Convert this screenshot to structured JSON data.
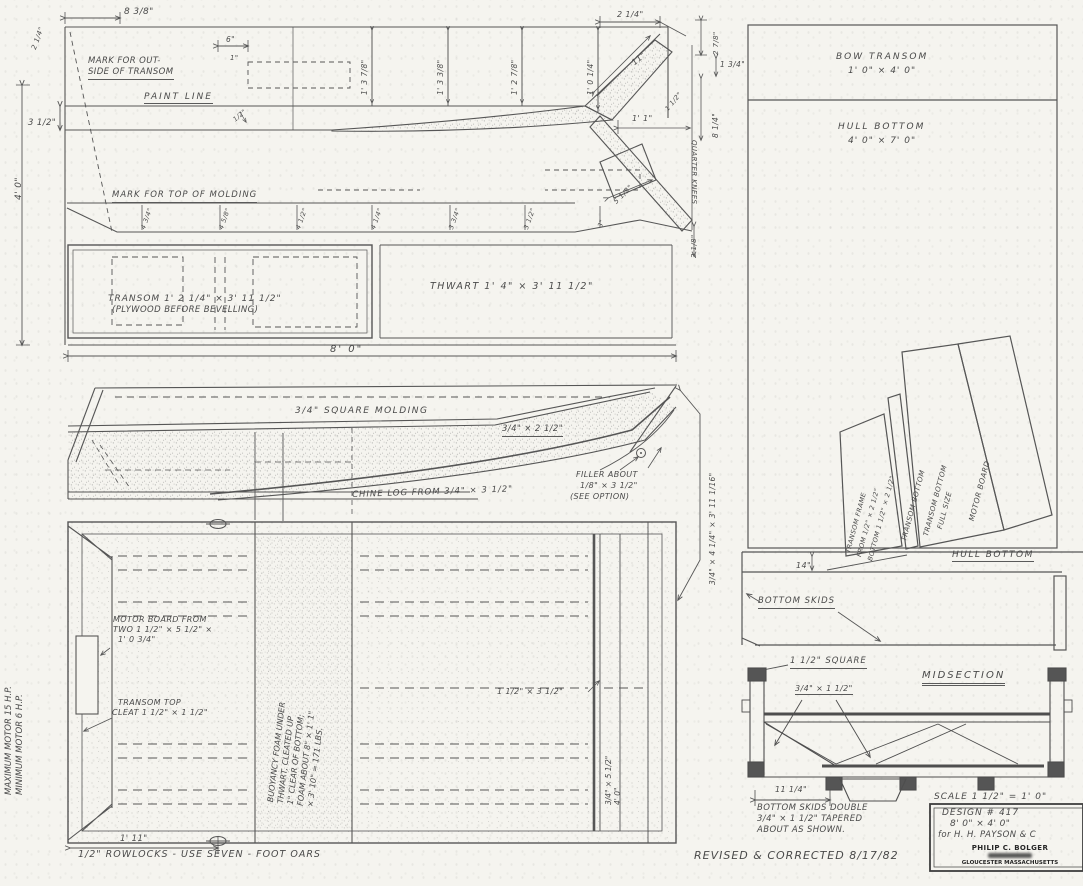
{
  "page": {
    "background": "#f5f4ef",
    "ink": "#4c4c4c"
  },
  "top_view": {
    "dim_top_left": "2 1/4\"",
    "dim_8_3_8": "8 3/8\"",
    "dim_6": "6\"",
    "dim_1": "1\"",
    "mark_outside_1": "MARK FOR OUT-",
    "mark_outside_2": "SIDE OF TRANSOM",
    "paint_line": "PAINT LINE",
    "dim_3_1_2": "3 1/2\"",
    "dim_4_0": "4' 0\"",
    "dim_half": "1/2\"",
    "station_dims": [
      "1' 3 7/8\"",
      "1' 3 3/8\"",
      "1' 2 7/8\"",
      "1' 0 1/4\""
    ],
    "dim_2_1_4": "2 1/4\"",
    "dim_2_7_8": "2 7/8\"",
    "dim_11": "11\"",
    "dim_1_3_4": "1 3/4\"",
    "dim_8_1_4": "8 1/4\"",
    "dim_1_1_2": "1 1/2\"",
    "dim_1_1": "1' 1\"",
    "quarter_knees": "QUARTER KNEES",
    "dim_5_1_2": "5 1/2\"",
    "dim_2_1_8": "2 1/8\"",
    "mark_molding": "MARK FOR TOP OF MOLDING",
    "edge_dims": [
      "4 3/4\"",
      "4 5/8\"",
      "4 1/2\"",
      "4 1/4\"",
      "3 3/4\"",
      "3 1/2\""
    ],
    "dim_3": "3\"",
    "transom_label": "TRANSOM  1' 2 1/4\" × 3' 11 1/2\"",
    "transom_sub": "(PLYWOOD BEFORE BEVELLING)",
    "thwart_label": "THWART  1' 4\" × 3' 11 1/2\"",
    "dim_8_0": "8' 0\""
  },
  "profile_view": {
    "molding": "3/4\" SQUARE MOLDING",
    "gunwale_dim": "3/4\" × 2 1/2\"",
    "chine": "CHINE LOG FROM 3/4\" × 3 1/2\"",
    "filler_1": "FILLER ABOUT",
    "filler_2": "1/8\" × 3 1/2\"",
    "filler_3": "(SEE OPTION)",
    "side_dim": "3/4\" × 4 1/4\" × 3' 11 1/16\""
  },
  "plan_view": {
    "motor_board_1": "MOTOR BOARD FROM",
    "motor_board_2": "TWO 1 1/2\" × 5 1/2\" ×",
    "motor_board_3": "1' 0 3/4\"",
    "cleat_1": "TRANSOM TOP",
    "cleat_2": "CLEAT 1 1/2\" × 1 1/2\"",
    "buoyancy_lines": [
      "BUOYANCY FOAM UNDER",
      "THWART, CLEATED UP",
      "1\" CLEAR OF BOTTOM;",
      "FOAM ABOUT 8\" × 1' 1\"",
      "× 3' 10\" = 171 LBS."
    ],
    "thwart_dim": "1 1/2\" × 3 1/2\"",
    "side_dim_1": "3/4\" × 5 1/2\"",
    "side_dim_2": "4' 0\"",
    "dim_1_11": "1' 11\"",
    "rowlocks_note": "1/2\" ROWLOCKS  -  USE SEVEN - FOOT OARS",
    "motor_note_1": "MAXIMUM MOTOR 15 H.P.",
    "motor_note_2": "MINIMUM MOTOR 6 H.P."
  },
  "panel_layout": {
    "bow_transom_1": "BOW TRANSOM",
    "bow_transom_2": "1' 0\" × 4' 0\"",
    "hull_bottom_1": "HULL BOTTOM",
    "hull_bottom_2": "4' 0\" × 7' 0\"",
    "frame_1": "TRANSOM FRAME",
    "frame_2": "FROM 1/2\" × 2 1/2\"",
    "frame_3": "BOTTOM 1 1/2\" × 2 1/2\"",
    "strip_label": "TRANSOM BOTTOM",
    "full_size_1": "TRANSOM BOTTOM",
    "full_size_2": "FULL SIZE",
    "motor_board": "MOTOR BOARD",
    "hull_bottom_edge": "HULL BOTTOM",
    "dim_14": "14\"",
    "bottom_skids": "BOTTOM SKIDS"
  },
  "midsection": {
    "square_note": "1 1/2\" SQUARE",
    "title": "MIDSECTION",
    "chine_dim": "3/4\" × 1 1/2\"",
    "dim_11_1_4": "11 1/4\"",
    "skid_note_1": "BOTTOM SKIDS DOUBLE",
    "skid_note_2": "3/4\" × 1 1/2\" TAPERED",
    "skid_note_3": "ABOUT AS SHOWN.",
    "scale_note": "SCALE 1 1/2\" = 1' 0\""
  },
  "title_block": {
    "design": "DESIGN # 417",
    "size": "8' 0\" × 4' 0\"",
    "client": "for H. H. PAYSON & C",
    "stamp_name": "PHILIP C. BOLGER",
    "stamp_city": "GLOUCESTER MASSACHUSETTS",
    "revision": "REVISED & CORRECTED 8/17/82"
  }
}
